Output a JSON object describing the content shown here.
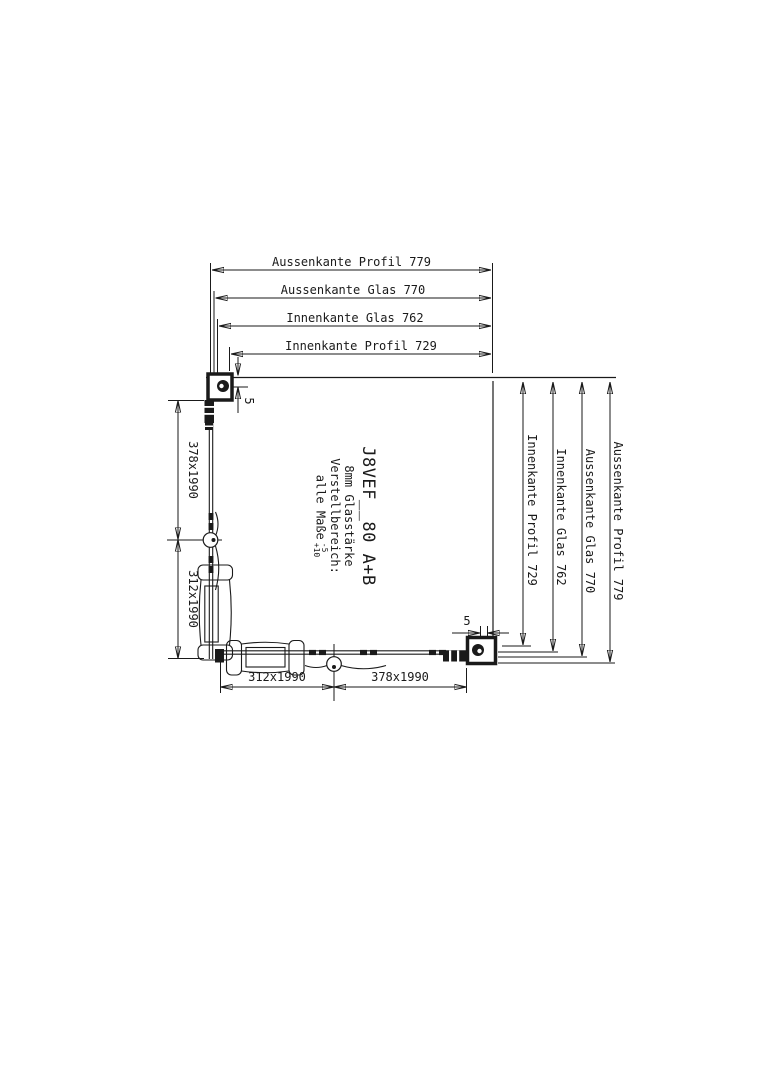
{
  "page": {
    "background": "#ffffff",
    "line_color": "#1a1a1a"
  },
  "dimensions": {
    "top": [
      "Aussenkante Profil 779",
      "Aussenkante Glas 770",
      "Innenkante Glas 762",
      "Innenkante Profil 729"
    ],
    "right": [
      "Innenkante Profil 729",
      "Innenkante Glas 762",
      "Aussenkante Glas 770",
      "Aussenkante Profil 779"
    ],
    "left": [
      "378x1990",
      "312x1990"
    ],
    "bottom": [
      "312x1990",
      "378x1990"
    ],
    "gap_top_left": "5",
    "gap_bottom_right": "5"
  },
  "title_block": {
    "model": "J8VEF__80 A+B",
    "glass_thickness": "8mm Glasstärke",
    "adjustment_label": "Verstellbereich:",
    "tolerance_label": "alle Maße",
    "tolerance_minus": "-5",
    "tolerance_plus": "+10"
  }
}
